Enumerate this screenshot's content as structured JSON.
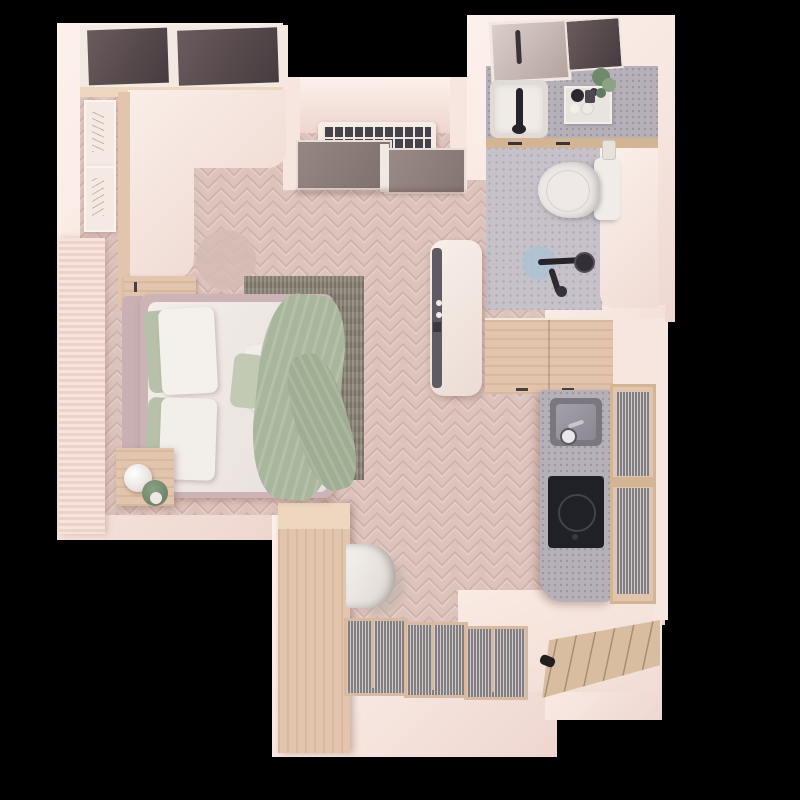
{
  "meta": {
    "scene": "top-down 3d rendered floor plan of a studio apartment on black background",
    "view": "top-down",
    "background": "#000000"
  },
  "palette": {
    "bg": "#000000",
    "wall": "#f7e6e0",
    "wall_bright": "#fdf1eb",
    "wall_shade": "#eed6cf",
    "floor_base": "#dcc3bc",
    "floor_seam": "#cbafa8",
    "floor_light": "#e8d1ca",
    "wood": "#e2c5ac",
    "wood_light": "#eed7bf",
    "wood_dark": "#d3b493",
    "terrazzo": "#c7c2c9",
    "terrazzo_dark": "#b6b1b9",
    "glass_window": "#5a4d50",
    "glass_slider": "#8d7d79",
    "bed_frame": "#ccb3b6",
    "duvet": "#f0eae6",
    "pillow_sage": "#b7c1a9",
    "throw_sage": "#a8b69b",
    "rug": "#8e8679",
    "fixture_black": "#26242a",
    "drain_blue": "#a9c3d2",
    "door_gray": "#5f5a63",
    "pale_floor": "#f7e7e0"
  },
  "rooms": {
    "bedroom": {
      "label": "bedroom",
      "furniture": [
        "window-wall-glazing",
        "wall-art-frame-1",
        "wall-art-frame-2",
        "floor-to-ceiling-curtain",
        "l-shaped-desk-counter",
        "desk-cabinet",
        "round-pouf",
        "double-bed",
        "headboard",
        "duvet",
        "sage-pillows",
        "white-pillows",
        "accent-cushions",
        "sage-throw-blanket",
        "area-rug",
        "nightstand",
        "table-lamp",
        "potted-plant",
        "tall-wardrobe-dark-front"
      ]
    },
    "ac_alcove": {
      "label": "recessed alcove",
      "furniture": [
        "ac-vent-grille",
        "sliding-glass-doors"
      ]
    },
    "bathroom": {
      "label": "bathroom",
      "furniture": [
        "mirror",
        "dark-window",
        "terrazzo-vanity-counter",
        "washbasin",
        "black-faucet",
        "toiletries-tray",
        "small-plant",
        "under-counter-drawers",
        "toilet",
        "cistern",
        "toiletry-bottle",
        "shower-partition-block",
        "black-shower-set",
        "floor-drain"
      ]
    },
    "kitchen": {
      "label": "kitchenette",
      "furniture": [
        "wood-base-cabinet",
        "terrazzo-counter",
        "inset-sink",
        "sink-faucet",
        "induction-cooktop",
        "fluted-glass-cabinet-doors"
      ]
    },
    "entry": {
      "label": "entry hall",
      "furniture": [
        "wood-partition-wall",
        "wall-hung-basin",
        "closet-fluted-glass-doors-x3",
        "genkan-wood-floor",
        "entrance-door-handle",
        "pale-floor-area"
      ]
    }
  }
}
